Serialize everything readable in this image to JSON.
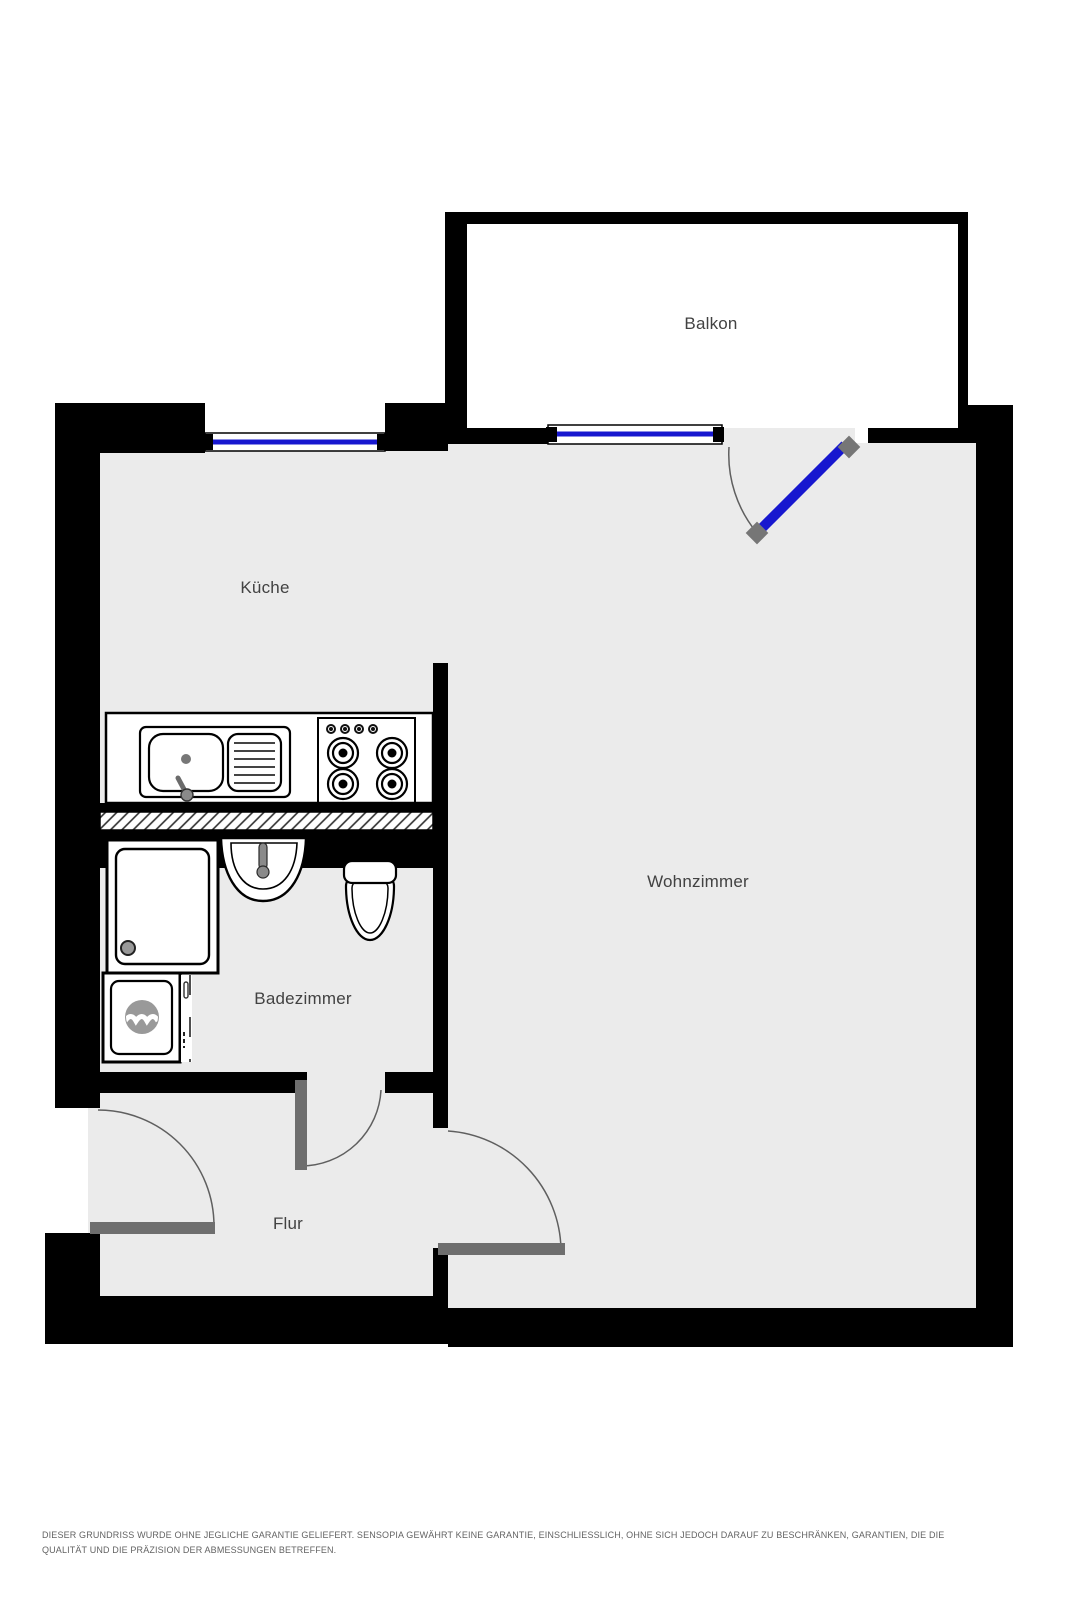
{
  "plan": {
    "rooms": [
      {
        "id": "balkon",
        "label": "Balkon"
      },
      {
        "id": "kueche",
        "label": "Küche"
      },
      {
        "id": "wohnzimmer",
        "label": "Wohnzimmer"
      },
      {
        "id": "badezimmer",
        "label": "Badezimmer"
      },
      {
        "id": "flur",
        "label": "Flur"
      }
    ],
    "fixtures": [
      "kitchen-sink-icon",
      "drainboard-icon",
      "stove-burners-icon",
      "shower-icon",
      "washbasin-icon",
      "toilet-icon",
      "washing-machine-icon"
    ],
    "features": [
      "kitchen-window",
      "living-room-window",
      "balcony-door",
      "entry-door",
      "bathroom-door",
      "living-room-door",
      "hatched-low-wall"
    ],
    "colors": {
      "wall": "#000000",
      "floor": "#ebebeb",
      "exterior": "#ffffff",
      "window_glass": "#1717cf",
      "door_leaf": "#6e6e6e",
      "hinge": "#767676",
      "swing_arc": "#5f5f5f",
      "label_text": "#424242",
      "disclaimer_text": "#636363"
    }
  },
  "disclaimer": {
    "line1": "DIESER GRUNDRISS WURDE OHNE JEGLICHE GARANTIE GELIEFERT. SENSOPIA GEWÄHRT KEINE GARANTIE, EINSCHLIESSLICH, OHNE SICH JEDOCH DARAUF ZU BESCHRÄNKEN, GARANTIEN, DIE DIE",
    "line2": "QUALITÄT UND DIE PRÄZISION DER ABMESSUNGEN BETREFFEN."
  }
}
